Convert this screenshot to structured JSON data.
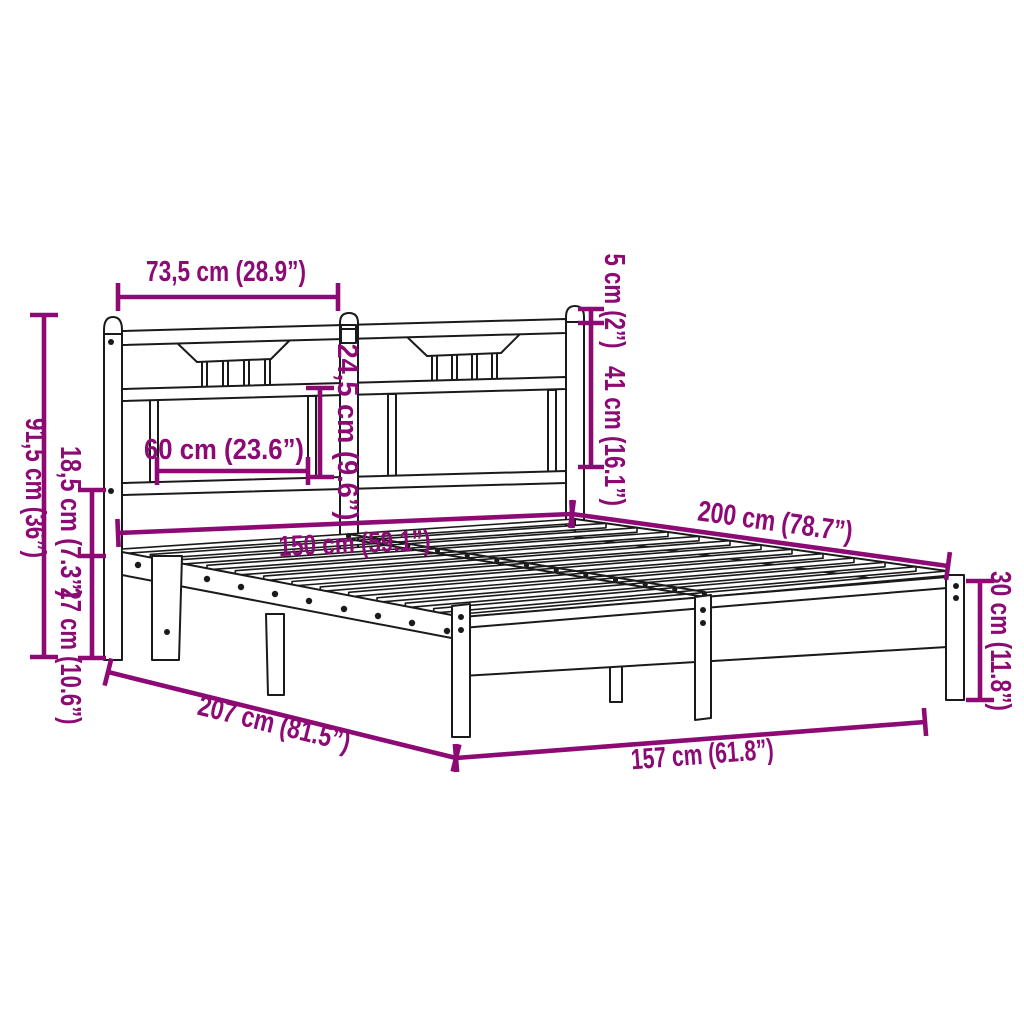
{
  "figure": {
    "type": "product-dimension-diagram",
    "subject": "metal bed frame with slatted base and headboard",
    "background_color": "#ffffff",
    "outline_color": "#1a1a1a",
    "dimension_color": "#8d0a75"
  },
  "dimensions": {
    "headboard_section_width": {
      "label": "73,5 cm (28.9”)",
      "cm": "73,5",
      "inch": "28.9"
    },
    "post_cap_height": {
      "label": "5 cm (2”)",
      "cm": "5",
      "inch": "2"
    },
    "headboard_upper_height": {
      "label": "41 cm (16.1”)",
      "cm": "41",
      "inch": "16.1"
    },
    "panel_opening_height": {
      "label": "24,5 cm (9.6”)",
      "cm": "24,5",
      "inch": "9.6"
    },
    "panel_opening_width": {
      "label": "60 cm (23.6”)",
      "cm": "60",
      "inch": "23.6"
    },
    "headboard_total_height": {
      "label": "91,5 cm (36”)",
      "cm": "91,5",
      "inch": "36"
    },
    "headboard_above_frame": {
      "label": "18,5 cm (7.3”)",
      "cm": "18,5",
      "inch": "7.3"
    },
    "frame_top_to_floor": {
      "label": "27 cm (10.6”)",
      "cm": "27",
      "inch": "10.6"
    },
    "slat_surface_width": {
      "label": "150 cm (59.1”)",
      "cm": "150",
      "inch": "59.1"
    },
    "slat_surface_length": {
      "label": "200 cm (78.7”)",
      "cm": "200",
      "inch": "78.7"
    },
    "foot_frame_height": {
      "label": "30 cm (11.8”)",
      "cm": "30",
      "inch": "11.8"
    },
    "overall_length": {
      "label": "207 cm (81.5”)",
      "cm": "207",
      "inch": "81.5"
    },
    "overall_width": {
      "label": "157 cm (61.8”)",
      "cm": "157",
      "inch": "61.8"
    }
  }
}
